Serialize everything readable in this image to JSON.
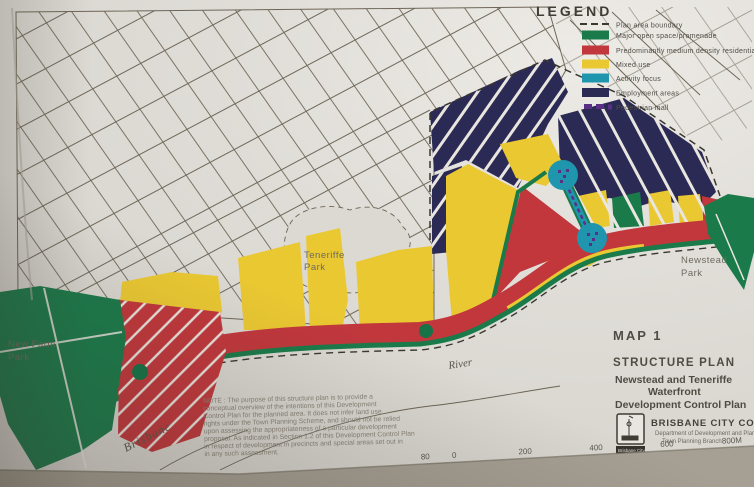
{
  "legend": {
    "title": "LEGEND",
    "items": [
      {
        "label": "Plan area boundary",
        "swatch": "black-dash"
      },
      {
        "label": "Major open space/promenade",
        "swatch": "green"
      },
      {
        "label": "Predominantly medium density residential",
        "swatch": "red"
      },
      {
        "label": "Mixed use",
        "swatch": "yellow"
      },
      {
        "label": "Activity focus",
        "swatch": "teal"
      },
      {
        "label": "Employment areas",
        "swatch": "navy"
      },
      {
        "label": "Pedestrian mall",
        "swatch": "purple-dash"
      }
    ]
  },
  "map_labels": {
    "teneriffe_park": [
      "Teneriffe",
      "Park"
    ],
    "newstead_park": [
      "Newstead",
      "Park"
    ],
    "new_farm_park": [
      "New Farm",
      "Park"
    ],
    "river": [
      "Brisbane",
      "River"
    ]
  },
  "title_block": {
    "map_number": "MAP 1",
    "plan_type": "STRUCTURE PLAN",
    "plan_name_line1": "Newstead and Teneriffe",
    "plan_name_line2": "Waterfront",
    "plan_name_line3": "Development Control Plan"
  },
  "council": {
    "name": "BRISBANE CITY COUNCIL",
    "department": "Department of Development and Planning",
    "branch": "Town Planning Branch",
    "logo_caption": "Brisbane City"
  },
  "note": {
    "lines": [
      "NOTE : The purpose of this structure plan is to provide a",
      "conceptual overview  of the intentions of this Development",
      "Control Plan for the planned area. It does not infer land use",
      "rights under the Town Planning Scheme, and should not be relied",
      "upon assessing the appropriateness of a particular development",
      "proposal. As indicated in Section 1.2 of this Development Control Plan",
      "in respect of development in precincts and special areas set out in",
      "in any such assessment."
    ]
  },
  "scale_bar": {
    "ticks": [
      "80",
      "0",
      "200",
      "400",
      "600",
      "800M"
    ],
    "map_no": "Map No 84"
  },
  "palette": {
    "open_space_green": "#1b7a4a",
    "residential_red": "#c1373c",
    "mixed_use_yellow": "#eac832",
    "activity_teal": "#2095ae",
    "employment_navy": "#2b2a55",
    "pedestrian_purple": "#5b2f86",
    "boundary_black": "#3a372f"
  }
}
